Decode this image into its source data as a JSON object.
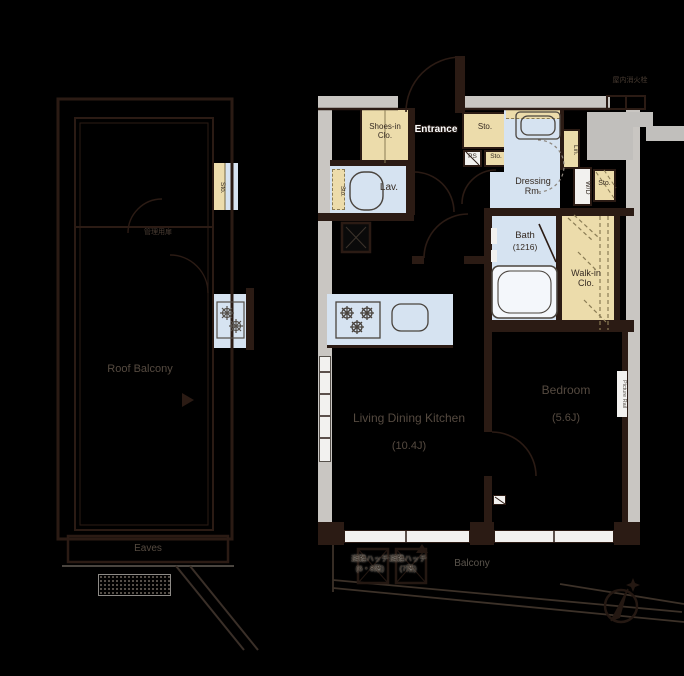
{
  "colors": {
    "background": "#000000",
    "wall_gray": "#c9c6c2",
    "wall_dark": "#2b1b14",
    "closet_cream": "#ecdcab",
    "wet_area_blue": "#d6e3f1",
    "label_dark": "#352a22",
    "label_dim": "#554a40"
  },
  "left_building": {
    "roof_balcony": "Roof Balcony",
    "eaves": "Eaves",
    "sto": "Sto.",
    "service_door": "管理用扉"
  },
  "unit": {
    "shoes_in_clo": "Shoes-in Clo.",
    "entrance": "Entrance",
    "sto_a": "Sto.",
    "ps": "PS",
    "sto_b": "Sto.",
    "lav": "Lav.",
    "lav_sto": "Sto.",
    "dressing": "Dressing Rm.",
    "lin": "Lin.",
    "wd": "W/D",
    "sto_c": "Sto.",
    "bath": "Bath",
    "bath_size": "(1216)",
    "walk_in": "Walk-in Clo.",
    "ldk": "Living Dining Kitchen",
    "ldk_size": "(10.4J)",
    "bedroom": "Bedroom",
    "bedroom_size": "(5.6J)",
    "picture_rail": "Picture Rail",
    "fire_hydrant": "屋内消火栓"
  },
  "balcony": {
    "label": "Balcony",
    "hatch_a_name": "避難ハッチ",
    "hatch_a_floors": "(6・8階)",
    "hatch_b_name": "避難ハッチ",
    "hatch_b_floors": "(7階)"
  }
}
